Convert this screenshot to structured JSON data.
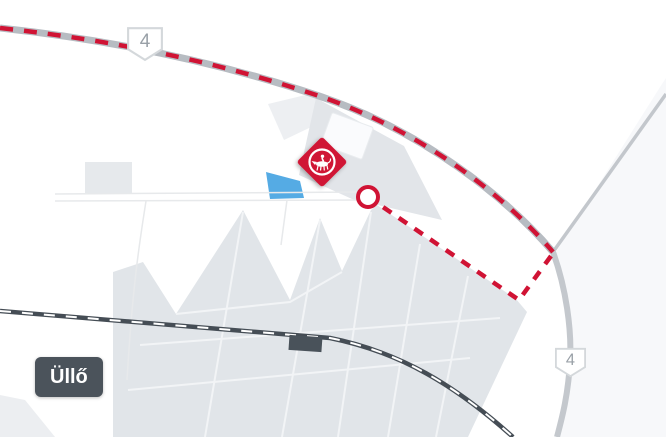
{
  "map": {
    "town_label": "Üllő",
    "shields": [
      {
        "label": "4",
        "position": "top"
      },
      {
        "label": "4",
        "position": "bottom-right"
      }
    ],
    "marker": {
      "icon": "horse-and-rider-emblem",
      "shape": "rotated-red-square",
      "color": "#d01334"
    },
    "route": {
      "style": "dashed",
      "color": "#d01334",
      "follows": "road-4-from-top-left-to-junction-then-offroad",
      "endpoint": "circle-outline"
    },
    "features": {
      "railway": "railway-line-bottom",
      "station": "station-building",
      "water": "pond",
      "urban_areas": [
        "industrial-area-north",
        "urban-area-south"
      ]
    },
    "colors": {
      "background": "#ffffff",
      "urban_area": "#e2e6ea",
      "road": "#b7bcc2",
      "secondary_road": "#c4c8cd",
      "railway": "#454d55",
      "water": "#55abe4",
      "accent_red": "#d01334",
      "label_background": "#4b535b",
      "shield_text": "#99a0a7"
    }
  }
}
